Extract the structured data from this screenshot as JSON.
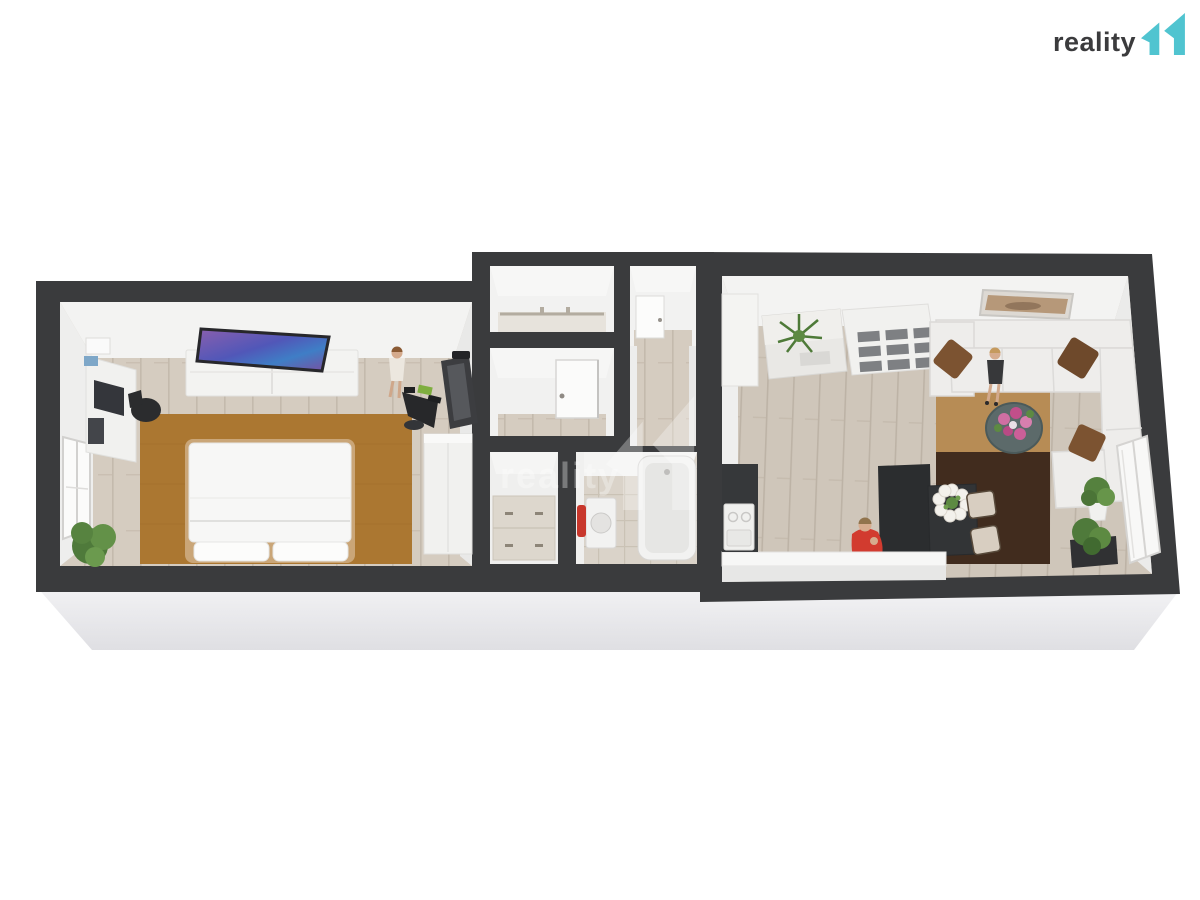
{
  "header": {
    "logo_text": "reality",
    "logo_mark": "11"
  },
  "watermark": {
    "text": "reality",
    "mark": "11"
  },
  "colors": {
    "accent_teal": "#50c4d0",
    "logo_text": "#3b3b3d",
    "wall": "#3a3b3d",
    "floor": "#d5ccc0",
    "floor_living": "#cfc6ba",
    "slab": "#ededef",
    "rug_bedroom": "#ab7731",
    "rug_tan": "#b78c55",
    "rug_dark": "#412c1e",
    "bed_frame": "#caa678",
    "table_teal": "#5c6a6a",
    "towel_red": "#c8372c",
    "person_red": "#d23b2f",
    "plant_green": "#5d8a42",
    "flower_pink": "#c95591",
    "art_brown": "#b69879",
    "dark_furniture": "#2b2d2f"
  },
  "scene": {
    "type": "3d-floor-plan-render",
    "inventory": {
      "bedroom": [
        "double-bed",
        "area-rug",
        "dresser",
        "wall-tv",
        "desk-with-computer",
        "office-chair",
        "window",
        "potted-plant",
        "person-standing",
        "exercise-bike",
        "treadmill",
        "wardrobe"
      ],
      "hall_and_bath": [
        "closet-with-rail",
        "entry-door",
        "hallway",
        "interior-door",
        "storage-cabinets",
        "bathtub",
        "washing-machine",
        "red-towel"
      ],
      "living_kitchen": [
        "tall-cabinet",
        "sideboard-with-plant",
        "cube-shelving",
        "corner-sofa",
        "throw-pillows",
        "person-standing",
        "round-coffee-table",
        "flower-bouquet",
        "area-rugs",
        "wall-art",
        "kitchen-island",
        "dining-table",
        "dining-chairs",
        "person-seated",
        "kitchen-counter",
        "stove",
        "potted-plants",
        "window"
      ]
    }
  }
}
